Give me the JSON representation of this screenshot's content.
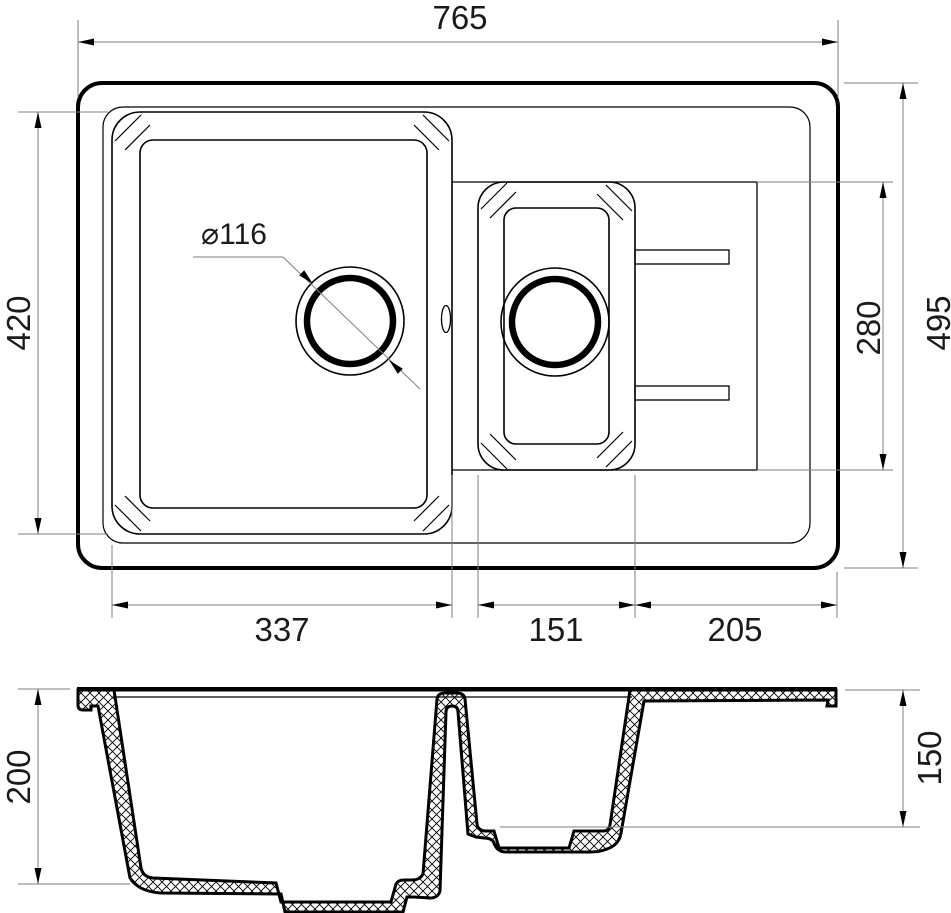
{
  "drawing": {
    "kind": "sink technical drawing",
    "views": {
      "top_view": "plan view with two bowls and drainboard",
      "section_view": "cross section with hatched walls"
    },
    "dimensions": {
      "overall_width": "765",
      "overall_depth": "495",
      "main_bowl_width": "337",
      "main_bowl_depth": "420",
      "small_bowl_width": "151",
      "small_bowl_region_depth": "280",
      "drainboard_width": "205",
      "drain_hole_diameter": "⌀116",
      "main_bowl_section_depth": "200",
      "small_bowl_section_depth": "150"
    },
    "colors": {
      "object_line": "#000000",
      "dimension_line": "#7f7f7f",
      "text": "#1a1a1a",
      "background": "#ffffff"
    }
  }
}
